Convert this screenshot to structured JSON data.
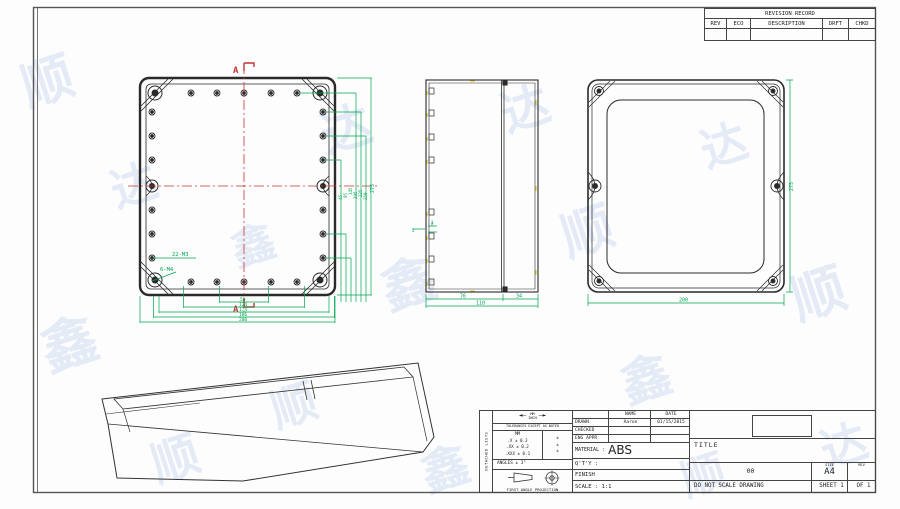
{
  "watermark": {
    "items": [
      {
        "ch": "顺",
        "x": 20,
        "y": 40,
        "s": 52,
        "r": -18
      },
      {
        "ch": "达",
        "x": 110,
        "y": 150,
        "s": 46,
        "r": -18
      },
      {
        "ch": "鑫",
        "x": 40,
        "y": 300,
        "s": 56,
        "r": -18
      },
      {
        "ch": "顺",
        "x": 150,
        "y": 420,
        "s": 48,
        "r": -18
      },
      {
        "ch": "达",
        "x": 320,
        "y": 90,
        "s": 50,
        "r": -18
      },
      {
        "ch": "鑫",
        "x": 380,
        "y": 240,
        "s": 54,
        "r": -18
      },
      {
        "ch": "顺",
        "x": 270,
        "y": 370,
        "s": 46,
        "r": -18
      },
      {
        "ch": "达",
        "x": 500,
        "y": 70,
        "s": 48,
        "r": -18
      },
      {
        "ch": "顺",
        "x": 560,
        "y": 190,
        "s": 52,
        "r": -18
      },
      {
        "ch": "鑫",
        "x": 620,
        "y": 340,
        "s": 50,
        "r": -18
      },
      {
        "ch": "达",
        "x": 700,
        "y": 110,
        "s": 46,
        "r": -18
      },
      {
        "ch": "顺",
        "x": 790,
        "y": 250,
        "s": 54,
        "r": -18
      },
      {
        "ch": "达",
        "x": 820,
        "y": 410,
        "s": 46,
        "r": -18
      },
      {
        "ch": "鑫",
        "x": 420,
        "y": 430,
        "s": 48,
        "r": -18
      },
      {
        "ch": "鑫",
        "x": 230,
        "y": 210,
        "s": 44,
        "r": -18
      },
      {
        "ch": "顺",
        "x": 680,
        "y": 440,
        "s": 44,
        "r": -18
      }
    ]
  },
  "revision_table": {
    "title": "REVISION RECORD",
    "columns": [
      "REV",
      "ECO",
      "DESCRIPTION",
      "DRFT",
      "CHKD"
    ]
  },
  "views": {
    "front": {
      "section_top": "A",
      "section_bottom": "A",
      "thread_holes_label": "22-M3",
      "corner_holes_label": "6-M4",
      "bottom_dims": [
        "50",
        "124",
        "174",
        "186",
        "200"
      ],
      "right_dims": [
        "45",
        "95",
        "145",
        "195",
        "225",
        "250",
        "275"
      ]
    },
    "side": {
      "body_depth": "76",
      "lid_depth": "34",
      "total_depth": "110",
      "wall_a": "3",
      "wall_b": "2"
    },
    "back": {
      "width": "200",
      "height": "275"
    }
  },
  "title_block": {
    "side_label": "DETACHED LISTS",
    "tolerance": {
      "units_top": "MM",
      "units_bottom": "INCH",
      "arrow_left": "◄—",
      "arrow_right": "—►",
      "note": "TOLERANCES EXCEPT AS NOTED",
      "col_header": "MM",
      "rows": [
        {
          "mm": ".X ± 0.3",
          "inch": "±"
        },
        {
          "mm": ".XX ± 0.2",
          "inch": "±"
        },
        {
          "mm": ".XXX ± 0.1",
          "inch": "±"
        }
      ],
      "angles": "ANGLES ± 3°",
      "projection": "FIRST ANGLE PROJECTION"
    },
    "approvals": {
      "name_header": "NAME",
      "date_header": "DATE",
      "rows": [
        {
          "role": "DRAWN",
          "name": "Aaron",
          "date": "01/15/2015"
        },
        {
          "role": "CHECKED",
          "name": "",
          "date": ""
        },
        {
          "role": "ENG APPR",
          "name": "",
          "date": ""
        }
      ]
    },
    "material_label": "MATERIAL :",
    "material_value": "ABS",
    "qty_label": "Q'T'Y :",
    "finish_label": "FINISH",
    "scale_label": "SCALE : 1:1",
    "title_label": "TITLE",
    "drawing_number": "00",
    "size_label": "SIZE",
    "size_value": "A4",
    "rev_label": "REV",
    "do_not_scale": "DO NOT SCALE DRAWING",
    "sheet_label": "SHEET 1",
    "of_label": "OF 1"
  },
  "colors": {
    "dimension_green": "#00A650",
    "centerline_red": "#C83232",
    "line_black": "#2a2a2a"
  }
}
